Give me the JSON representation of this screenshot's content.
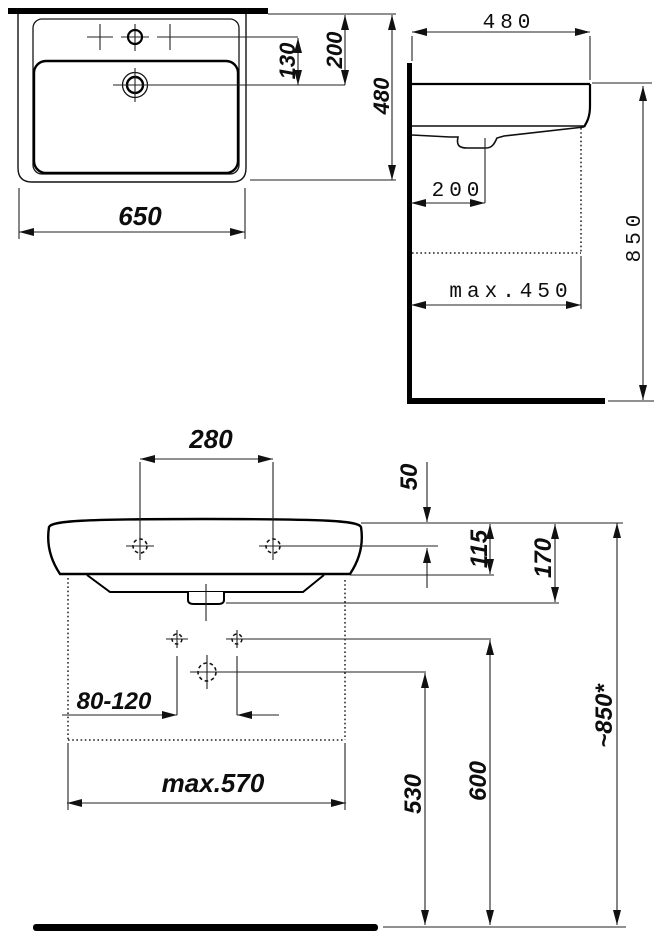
{
  "dims": {
    "top_view": {
      "width": "650",
      "tap_to_drain": "130",
      "back_to_drain": "200",
      "depth": "480"
    },
    "side_view": {
      "depth": "480",
      "drain_from_wall": "200",
      "clearance": "max.450",
      "height": "850"
    },
    "front_view": {
      "tap_spacing": "280",
      "rim_to_fixing_holes": "50",
      "rim_to_basin_bottom": "115",
      "rim_to_outlet": "170",
      "supply_spacing": "80-120",
      "max_width": "max.570",
      "trap_height": "530",
      "supply_height": "600",
      "rim_height": "~850*"
    }
  }
}
